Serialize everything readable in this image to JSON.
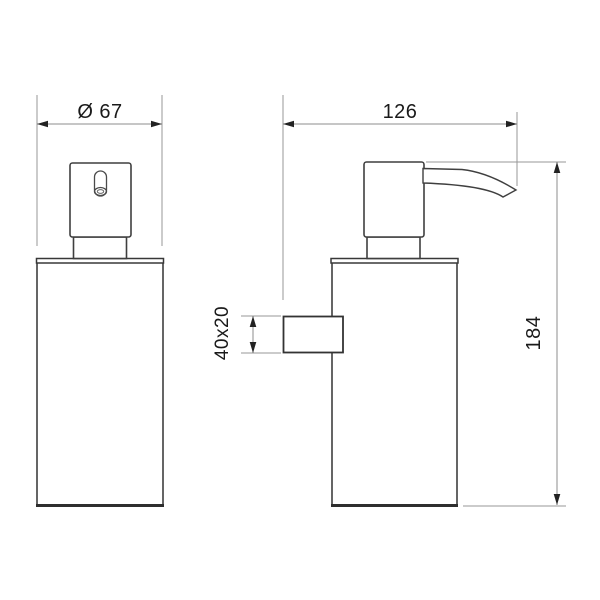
{
  "drawing": {
    "dimensions": {
      "front_width_label": "Ø 67",
      "depth_label": "126",
      "bracket_label": "40x20",
      "height_label": "184"
    },
    "colors": {
      "background": "#ffffff",
      "part_outline": "#3f3f3f",
      "heavy_edge": "#2e2e2e",
      "dimension_line": "#8c8c8c",
      "label_text": "#1a1a1a"
    }
  }
}
